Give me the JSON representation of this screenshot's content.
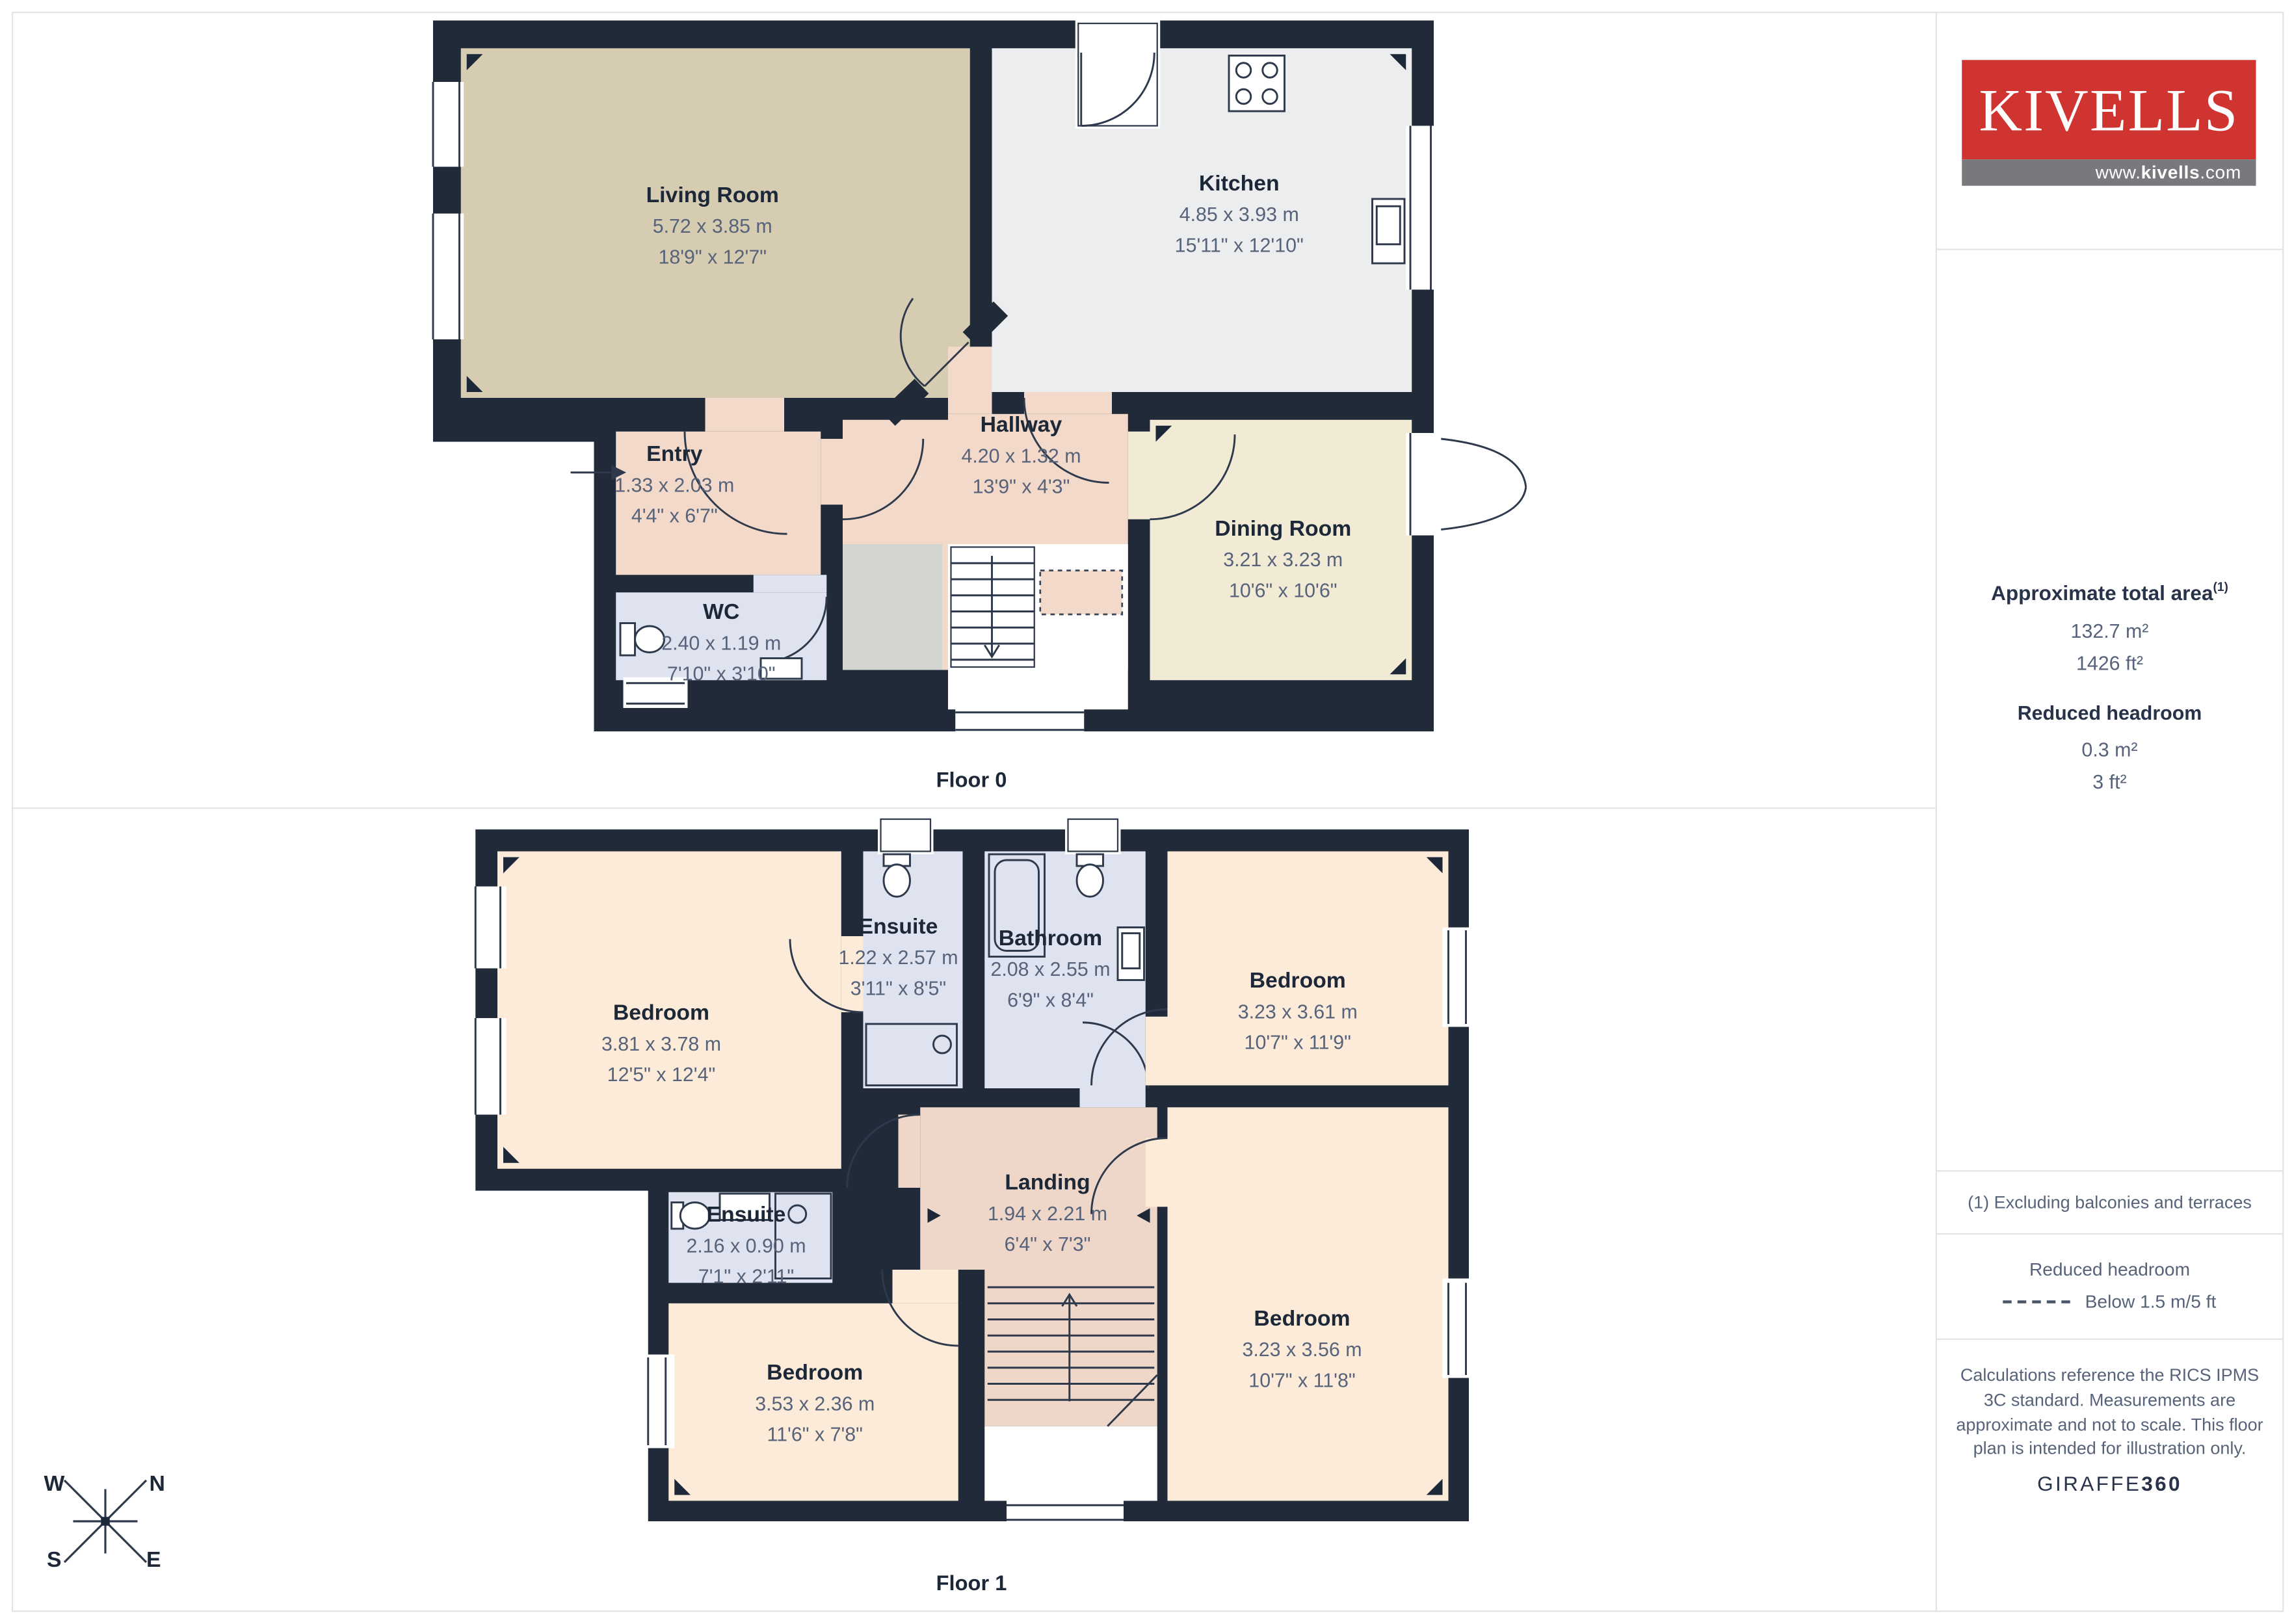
{
  "branding": {
    "logo_text": "KIVELLS",
    "website_prefix": "www.",
    "website_mid": "kivells",
    "website_suffix": ".com",
    "brand_red": "#cf3430",
    "bar_gray": "#77797c"
  },
  "sidebar": {
    "total_area": {
      "title": "Approximate total area",
      "superscript": "(1)",
      "metric": "132.7 m²",
      "imperial": "1426 ft²"
    },
    "reduced_headroom": {
      "title": "Reduced headroom",
      "metric": "0.3 m²",
      "imperial": "3 ft²"
    },
    "footnote": "(1) Excluding balconies and terraces",
    "legend": {
      "title": "Reduced headroom",
      "item": "Below 1.5 m/5 ft"
    },
    "disclaimer": "Calculations reference the RICS IPMS 3C standard. Measurements are approximate and not to scale. This floor plan is intended for illustration only.",
    "credit_normal": "GIRAFFE",
    "credit_bold": "360"
  },
  "compass": {
    "west": "W",
    "north": "N",
    "south": "S",
    "east": "E"
  },
  "floors": [
    {
      "label": "Floor 0",
      "rooms": [
        {
          "name": "Living Room",
          "metric": "5.72 x 3.85 m",
          "imperial": "18'9\" x 12'7\""
        },
        {
          "name": "Kitchen",
          "metric": "4.85 x 3.93 m",
          "imperial": "15'11\" x 12'10\""
        },
        {
          "name": "Hallway",
          "metric": "4.20 x 1.32 m",
          "imperial": "13'9\" x 4'3\""
        },
        {
          "name": "Entry",
          "metric": "1.33 x 2.03 m",
          "imperial": "4'4\" x 6'7\""
        },
        {
          "name": "WC",
          "metric": "2.40 x 1.19 m",
          "imperial": "7'10\" x 3'10\""
        },
        {
          "name": "Dining Room",
          "metric": "3.21 x 3.23 m",
          "imperial": "10'6\" x 10'6\""
        }
      ]
    },
    {
      "label": "Floor 1",
      "rooms": [
        {
          "name": "Bedroom",
          "metric": "3.81 x 3.78 m",
          "imperial": "12'5\" x 12'4\""
        },
        {
          "name": "Ensuite",
          "metric": "1.22 x 2.57 m",
          "imperial": "3'11\" x 8'5\""
        },
        {
          "name": "Bathroom",
          "metric": "2.08 x 2.55 m",
          "imperial": "6'9\" x 8'4\""
        },
        {
          "name": "Bedroom",
          "metric": "3.23 x 3.61 m",
          "imperial": "10'7\" x 11'9\""
        },
        {
          "name": "Landing",
          "metric": "1.94 x 2.21 m",
          "imperial": "6'4\" x 7'3\""
        },
        {
          "name": "Ensuite",
          "metric": "2.16 x 0.90 m",
          "imperial": "7'1\" x 2'11\""
        },
        {
          "name": "Bedroom",
          "metric": "3.53 x 2.36 m",
          "imperial": "11'6\" x 7'8\""
        },
        {
          "name": "Bedroom",
          "metric": "3.23 x 3.56 m",
          "imperial": "10'7\" x 11'8\""
        }
      ]
    }
  ]
}
